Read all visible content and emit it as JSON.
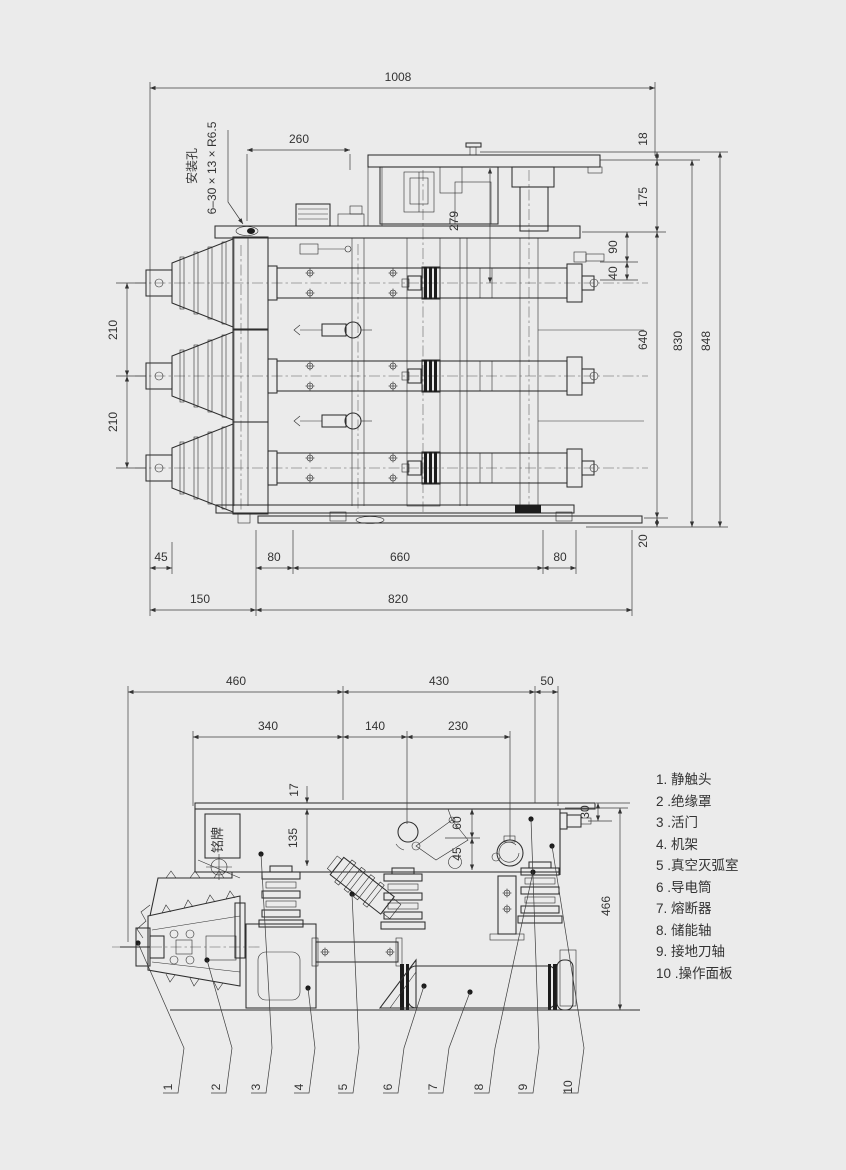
{
  "canvas": {
    "background": "#ebebeb",
    "line_color": "#2e2e2e"
  },
  "top_view": {
    "note": {
      "line1": "安装孔",
      "line2": "6–30 × 13 × R6.5"
    },
    "dims": {
      "w1008": "1008",
      "w260": "260",
      "h18": "18",
      "h175": "175",
      "h279": "279",
      "h90": "90",
      "h40": "40",
      "h640": "640",
      "h830": "830",
      "h848": "848",
      "h20": "20",
      "h210a": "210",
      "h210b": "210",
      "w45": "45",
      "w80a": "80",
      "w660": "660",
      "w80b": "80",
      "w150": "150",
      "w820": "820"
    }
  },
  "front_view": {
    "nameplate": "铭牌",
    "dims": {
      "w460": "460",
      "w430": "430",
      "w50": "50",
      "w340": "340",
      "w140": "140",
      "w230": "230",
      "h17": "17",
      "h135": "135",
      "h60": "60",
      "h45": "45",
      "h30": "30",
      "h466": "466"
    },
    "callouts": [
      "1",
      "2",
      "3",
      "4",
      "5",
      "6",
      "7",
      "8",
      "9",
      "10"
    ]
  },
  "legend": {
    "items": [
      "1. 静触头",
      "2 .绝缘罩",
      "3 .活门",
      "4. 机架",
      "5 .真空灭弧室",
      "6 .导电筒",
      "7. 熔断器",
      "8. 储能轴",
      "9. 接地刀轴",
      "10 .操作面板"
    ]
  }
}
